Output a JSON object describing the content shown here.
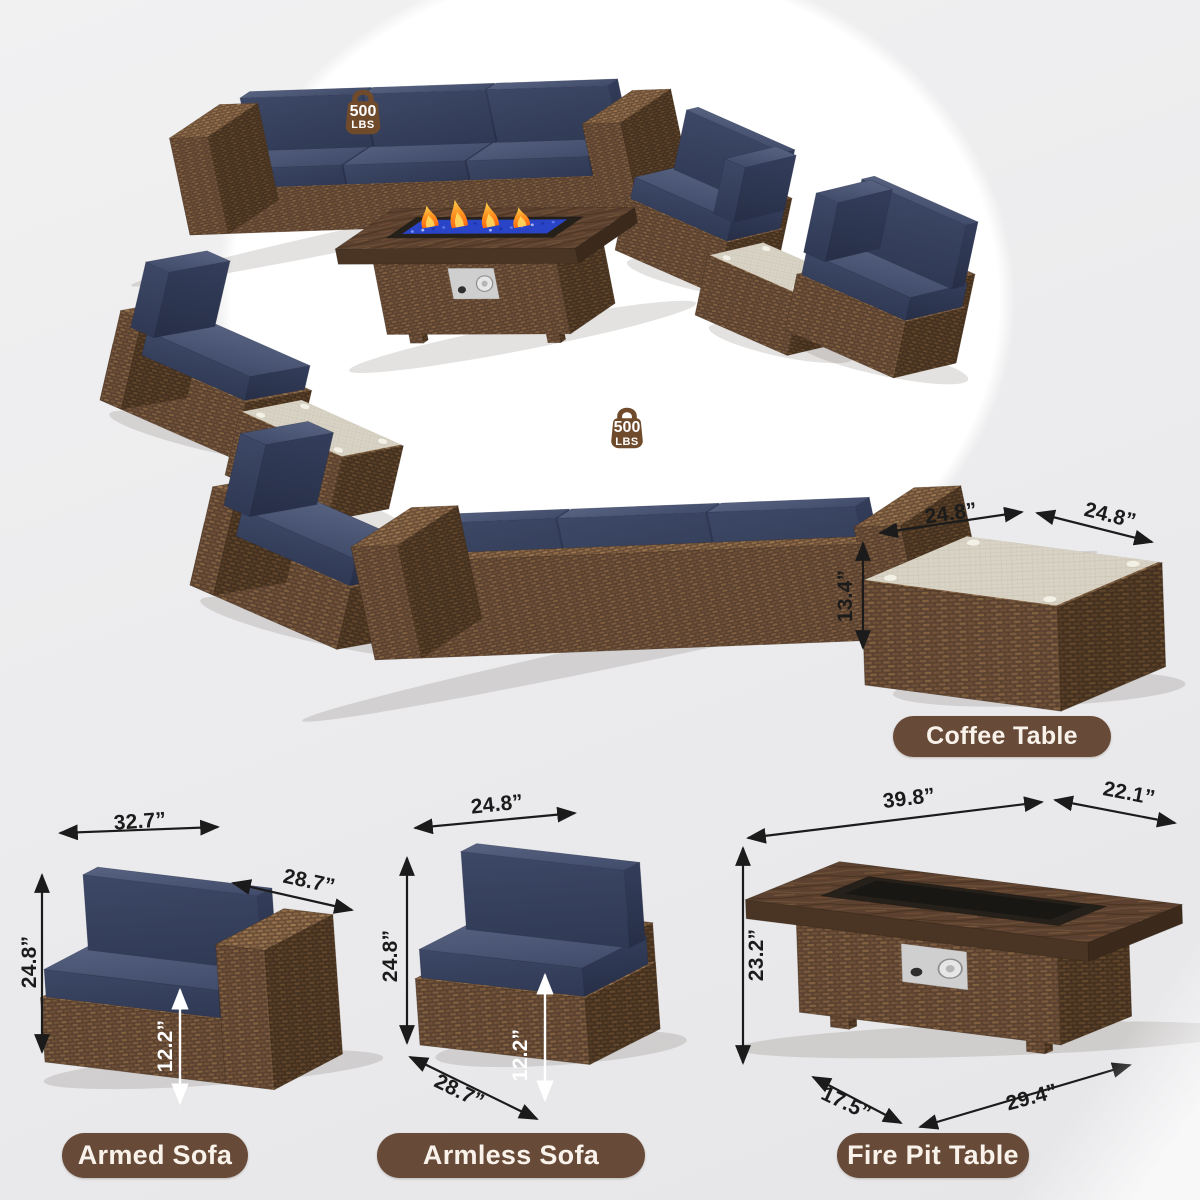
{
  "scene": {
    "weight_badge": {
      "value": "500",
      "unit": "LBS"
    }
  },
  "products": {
    "coffee_table": {
      "label": "Coffee Table",
      "dim_top_left": "24.8”",
      "dim_top_right": "24.8”",
      "dim_height": "13.4”"
    },
    "armed_sofa": {
      "label": "Armed Sofa",
      "dim_width": "32.7”",
      "dim_depth": "28.7”",
      "dim_height": "24.8”",
      "dim_seat_height": "12.2”"
    },
    "armless_sofa": {
      "label": "Armless Sofa",
      "dim_width": "24.8”",
      "dim_depth": "28.7”",
      "dim_height": "24.8”",
      "dim_seat_height": "12.2”"
    },
    "fire_pit_table": {
      "label": "Fire Pit Table",
      "dim_top_length": "39.8”",
      "dim_top_width": "22.1”",
      "dim_height": "23.2”",
      "dim_base_depth": "17.5”",
      "dim_base_length": "29.4”"
    }
  },
  "colors": {
    "pill": "#684a38",
    "badge": "#6f4a2b",
    "navy_cushion": "#3e4964",
    "wicker_brown": "#5a4130",
    "fire_glass_blue": "#2944c6",
    "flame_orange": "#ff9a26",
    "dimension_text": "#1b1b1b"
  }
}
